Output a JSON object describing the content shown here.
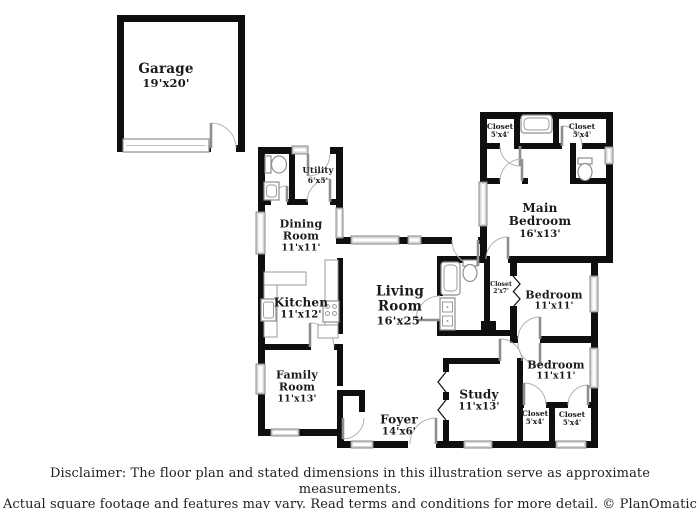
{
  "document": {
    "type": "floor-plan",
    "background": "#ffffff"
  },
  "colors": {
    "wall": "#0f0f0f",
    "label_text": "#1a1a1a",
    "window_fill": "#d8d8d8",
    "window_border": "#8a8a8a",
    "fixture_border": "#8f8f8f",
    "door_arc": "#b3b3b3"
  },
  "rooms": [
    {
      "id": "garage",
      "name": "Garage",
      "dims": "19'x20'"
    },
    {
      "id": "utility",
      "name": "Utility",
      "dims": "6'x5'"
    },
    {
      "id": "dining-room",
      "name": "Dining Room",
      "dims": "11'x11'"
    },
    {
      "id": "kitchen",
      "name": "Kitchen",
      "dims": "11'x12'"
    },
    {
      "id": "living-room",
      "name": "Living Room",
      "dims": "16'x25'"
    },
    {
      "id": "family-room",
      "name": "Family Room",
      "dims": "11'x13'"
    },
    {
      "id": "foyer",
      "name": "Foyer",
      "dims": "14'x6'"
    },
    {
      "id": "study",
      "name": "Study",
      "dims": "11'x13'"
    },
    {
      "id": "main-bedroom",
      "name": "Main Bedroom",
      "dims": "16'x13'"
    },
    {
      "id": "bedroom-middle",
      "name": "Bedroom",
      "dims": "11'x11'"
    },
    {
      "id": "bedroom-lower",
      "name": "Bedroom",
      "dims": "11'x11'"
    },
    {
      "id": "closet-top-left",
      "name": "Closet",
      "dims": "5'x4'"
    },
    {
      "id": "closet-top-right",
      "name": "Closet",
      "dims": "5'x4'"
    },
    {
      "id": "closet-hall",
      "name": "Closet",
      "dims": "2'x7'"
    },
    {
      "id": "closet-bottom-left",
      "name": "Closet",
      "dims": "5'x4'"
    },
    {
      "id": "closet-bottom-right",
      "name": "Closet",
      "dims": "5'x4'"
    }
  ],
  "disclaimer": {
    "line1": "Disclaimer: The floor plan and stated dimensions in this illustration serve as approximate measurements.",
    "line2": "Actual square footage and features may vary. Read terms and conditions for more detail. © PlanOmatic"
  }
}
